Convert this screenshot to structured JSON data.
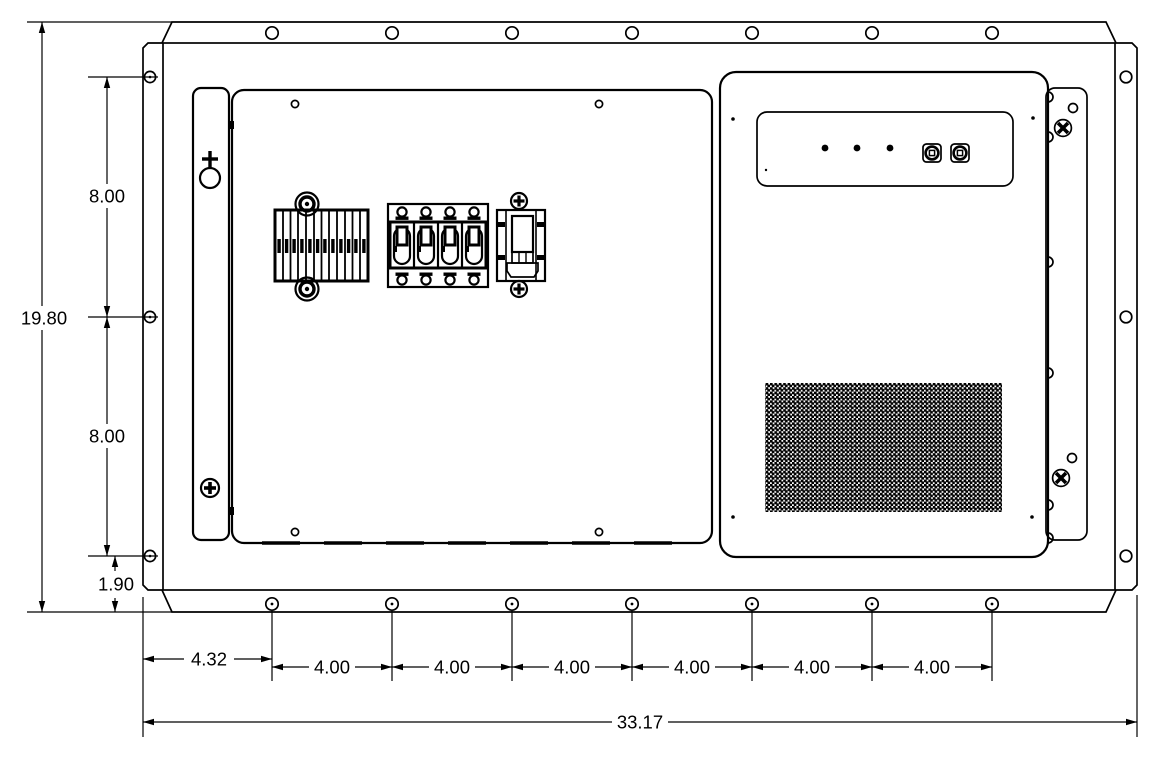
{
  "drawing": {
    "background": "#ffffff",
    "line_color": "#000000",
    "dims": {
      "overall_width": "33.17",
      "overall_height": "19.80",
      "side_hole_pitch_upper": "8.00",
      "side_hole_pitch_lower": "8.00",
      "side_hole_edge_offset": "1.90",
      "bottom_hole_edge_offset": "4.32",
      "bottom_hole_pitches": [
        "4.00",
        "4.00",
        "4.00",
        "4.00",
        "4.00",
        "4.00"
      ]
    },
    "features": {
      "top_flange_holes": 7,
      "bottom_flange_holes": 7,
      "left_flange_holes": 3,
      "right_flange_holes": 3,
      "status_leds": 3,
      "round_connectors": 2,
      "breaker_poles": 4
    }
  }
}
